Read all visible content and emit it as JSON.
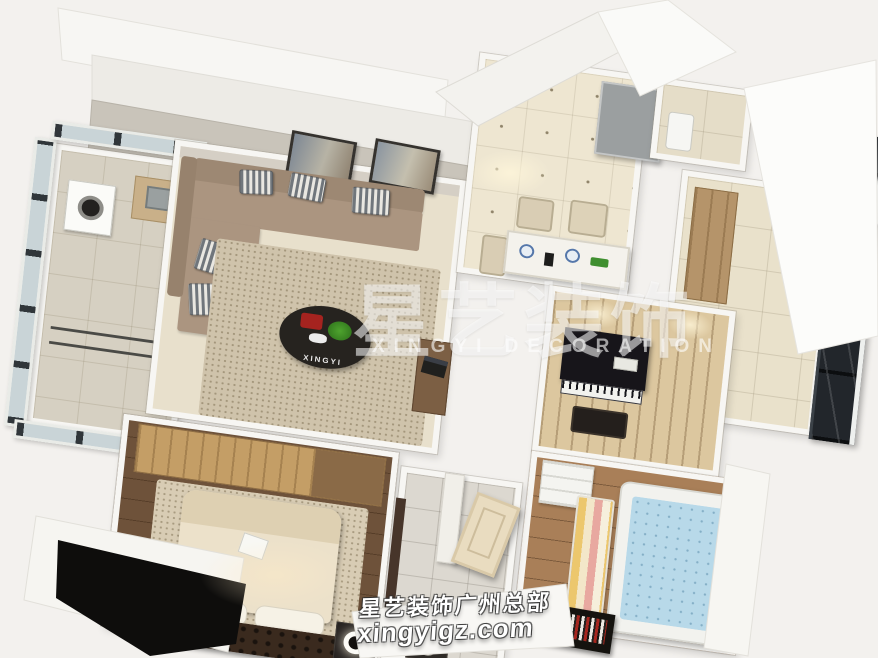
{
  "scene": {
    "type": "3D apartment floor-plan rendering, bird's-eye view",
    "rooms": [
      "balcony-laundry",
      "living-room",
      "entry-hall",
      "dining-area",
      "kitchen",
      "piano-room",
      "kids-room",
      "master-bedroom",
      "bathroom"
    ]
  },
  "watermarks": {
    "center_cn": "星艺装饰",
    "center_en": "XINGYI  DECORATION",
    "bottom_line1": "星艺装饰广州总部",
    "bottom_line2": "xingyigz.com",
    "coffee_table_logo": "XINGYI"
  },
  "colors": {
    "background": "#f3f1ee",
    "wall_white": "#f7f6f3",
    "tile_cream": "#ece4cf",
    "sofa_taupe": "#ab9580",
    "wardrobe_wood": "#c49e66",
    "bedroom_floor": "#6e523a",
    "kids_floor": "#a97f58",
    "kids_mattress": "#b8d9e9",
    "piano_black": "#17151a",
    "watermark_white": "rgba(255,255,255,0.55)"
  }
}
